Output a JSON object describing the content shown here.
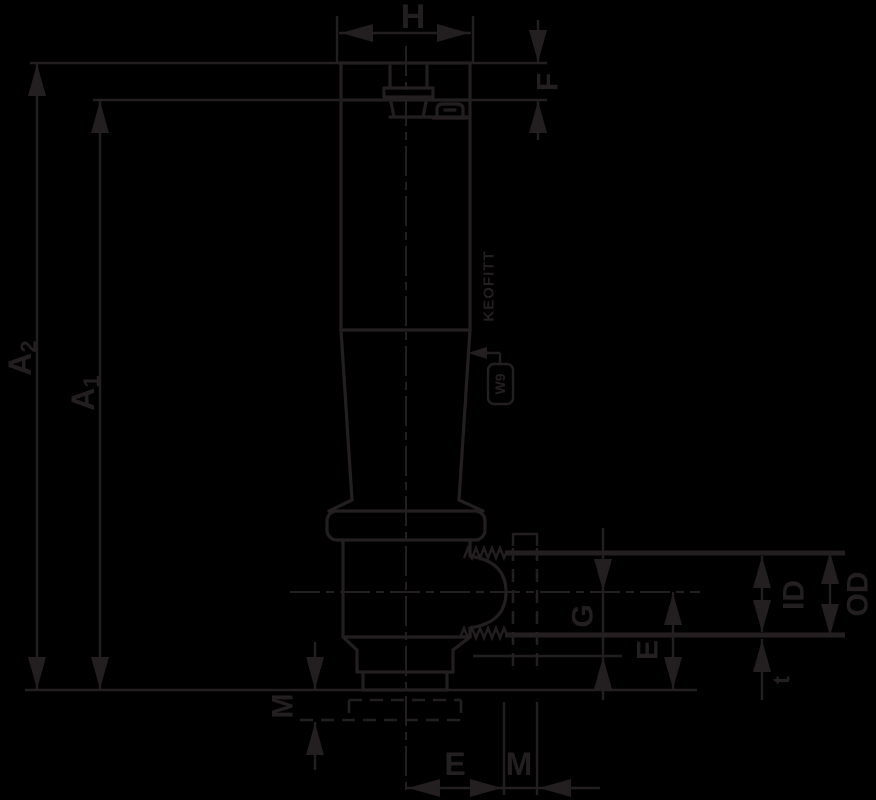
{
  "drawing": {
    "background_color": "#000000",
    "ink_color": "#231f20",
    "labels": {
      "h": "H",
      "f": "F",
      "a2_base": "A",
      "a2_sub": "2",
      "a1_base": "A",
      "a1_sub": "1",
      "m_left": "M",
      "g": "G",
      "e_right": "E",
      "id": "ID",
      "od": "OD",
      "t": "t",
      "e_bottom": "E",
      "m_bottom": "M",
      "body_marking": "KEOFITT",
      "flag_label": "W9"
    }
  }
}
